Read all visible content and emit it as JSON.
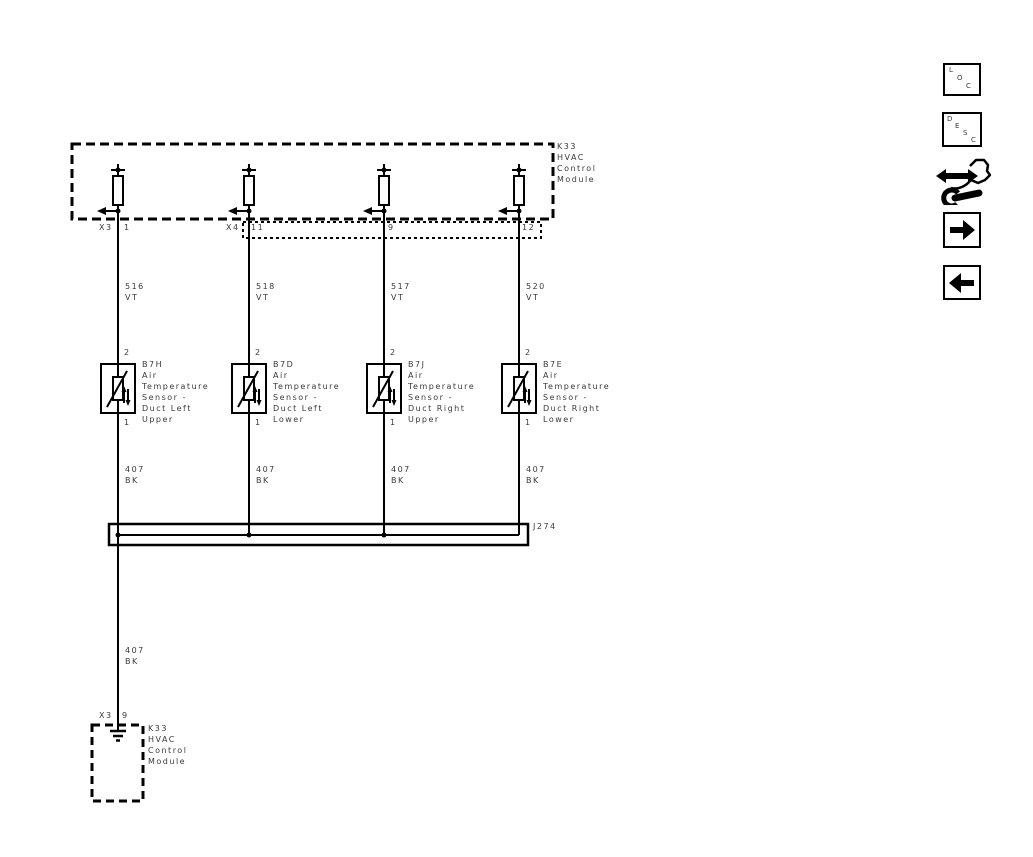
{
  "colors": {
    "background": "#ffffff",
    "line": "#000000",
    "text": "#3a3a3a"
  },
  "top_module": {
    "id_label": [
      "K33",
      "HVAC",
      "Control",
      "Module"
    ],
    "connectors": [
      {
        "connector": "X3",
        "pin": "1"
      },
      {
        "connector": "X4",
        "pin": "11"
      },
      {
        "connector": "",
        "pin": "9"
      },
      {
        "connector": "",
        "pin": "12"
      }
    ]
  },
  "circuits": [
    {
      "wire": {
        "id": "516",
        "color": "VT"
      },
      "pin_top": "2",
      "pin_bottom": "1",
      "sensor": {
        "id": "B7H",
        "desc": [
          "Air",
          "Temperature",
          "Sensor -",
          "Duct Left",
          "Upper"
        ]
      },
      "ground_wire": {
        "id": "407",
        "color": "BK"
      }
    },
    {
      "wire": {
        "id": "518",
        "color": "VT"
      },
      "pin_top": "2",
      "pin_bottom": "1",
      "sensor": {
        "id": "B7D",
        "desc": [
          "Air",
          "Temperature",
          "Sensor -",
          "Duct Left",
          "Lower"
        ]
      },
      "ground_wire": {
        "id": "407",
        "color": "BK"
      }
    },
    {
      "wire": {
        "id": "517",
        "color": "VT"
      },
      "pin_top": "2",
      "pin_bottom": "1",
      "sensor": {
        "id": "B7J",
        "desc": [
          "Air",
          "Temperature",
          "Sensor -",
          "Duct Right",
          "Upper"
        ]
      },
      "ground_wire": {
        "id": "407",
        "color": "BK"
      }
    },
    {
      "wire": {
        "id": "520",
        "color": "VT"
      },
      "pin_top": "2",
      "pin_bottom": "1",
      "sensor": {
        "id": "B7E",
        "desc": [
          "Air",
          "Temperature",
          "Sensor -",
          "Duct Right",
          "Lower"
        ]
      },
      "ground_wire": {
        "id": "407",
        "color": "BK"
      }
    }
  ],
  "splice": {
    "id": "J274"
  },
  "ground_run": {
    "wire": {
      "id": "407",
      "color": "BK"
    },
    "connector": "X3",
    "pin": "9"
  },
  "bottom_module": {
    "id_label": [
      "K33",
      "HVAC",
      "Control",
      "Module"
    ]
  },
  "toolbar": {
    "loc_letters": [
      "L",
      "O",
      "C"
    ],
    "desc_letters": [
      "D",
      "E",
      "S",
      "C"
    ],
    "icon_names": [
      "service-info-hand-wrench-icon",
      "arrow-right-icon",
      "arrow-left-icon"
    ]
  }
}
